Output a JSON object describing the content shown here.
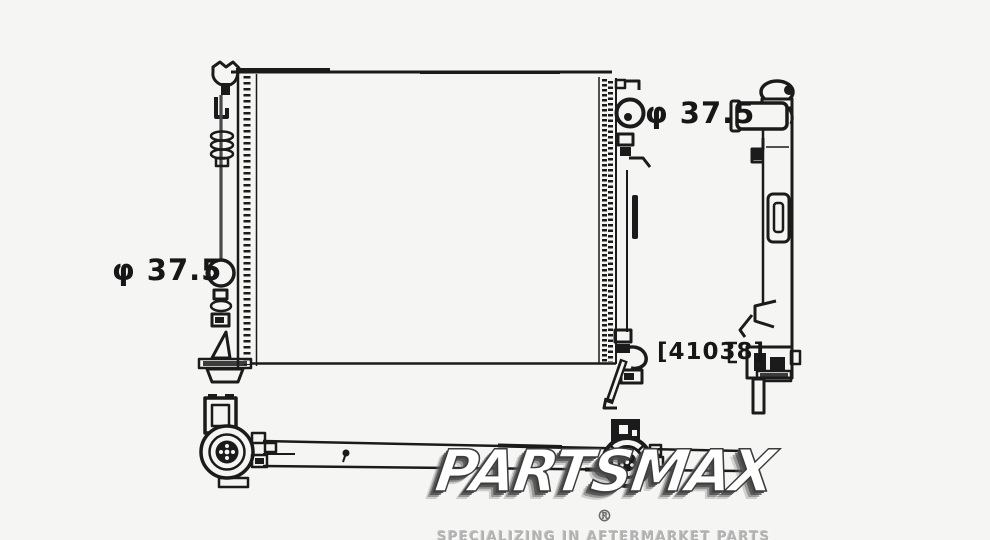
{
  "canvas": {
    "background_color": "#f5f5f3",
    "line_color": "#1b1b1b"
  },
  "annotations": {
    "left_port_diameter": "φ 37.5",
    "top_right_port_diameter": "φ 37.5",
    "part_number": "[41038]"
  },
  "watermark": {
    "brand": "PARTSMAX",
    "registered_mark": "®",
    "tagline": "SPECIALIZING IN AFTERMARKET PARTS",
    "brand_fill_color": "#ffffff",
    "brand_outline_color": "#3c3c3c",
    "tagline_color": "#b2b2b2"
  }
}
